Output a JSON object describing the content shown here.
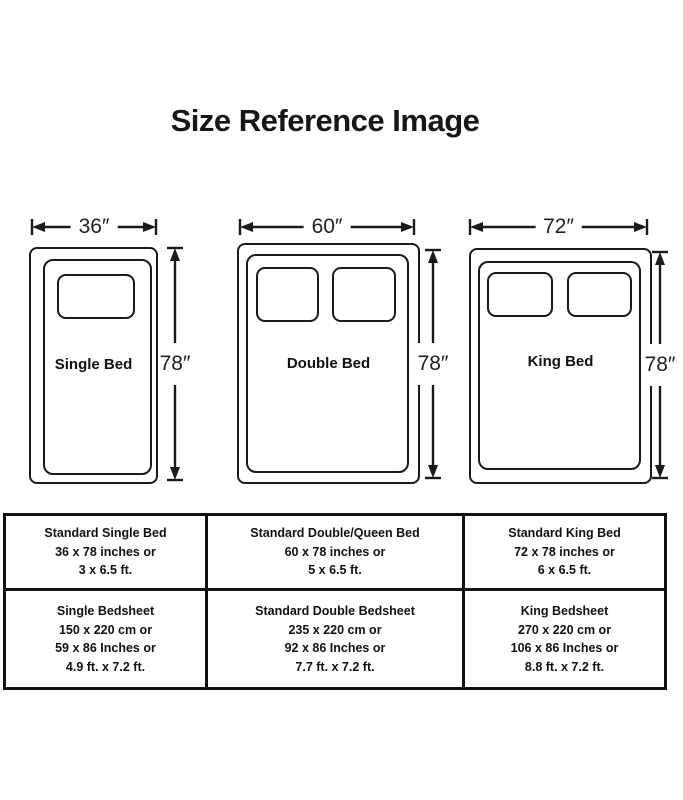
{
  "title": "Size Reference Image",
  "beds": [
    {
      "name": "Single Bed",
      "width": "36″",
      "height": "78″"
    },
    {
      "name": "Double Bed",
      "width": "60″",
      "height": "78″"
    },
    {
      "name": "King Bed",
      "width": "72″",
      "height": "78″"
    }
  ],
  "table": {
    "rows": [
      {
        "cells": [
          {
            "lines": [
              "Standard Single Bed",
              "36 x 78 inches or",
              "3 x 6.5 ft."
            ]
          },
          {
            "lines": [
              "Standard Double/Queen Bed",
              "60 x 78 inches or",
              "5 x 6.5 ft."
            ]
          },
          {
            "lines": [
              "Standard King Bed",
              "72 x 78 inches or",
              "6 x 6.5 ft."
            ]
          }
        ]
      },
      {
        "cells": [
          {
            "lines": [
              "Single Bedsheet",
              "150 x 220 cm or",
              "59 x 86 Inches or",
              "4.9 ft. x 7.2 ft."
            ]
          },
          {
            "lines": [
              "Standard Double Bedsheet",
              "235 x 220 cm or",
              "92 x 86 Inches or",
              "7.7 ft. x 7.2 ft."
            ]
          },
          {
            "lines": [
              "King Bedsheet",
              "270 x 220 cm or",
              "106 x 86 Inches or",
              "8.8 ft. x 7.2 ft."
            ]
          }
        ]
      }
    ]
  },
  "colors": {
    "line": "#1a1a1a",
    "text": "#111111",
    "background": "#ffffff"
  }
}
